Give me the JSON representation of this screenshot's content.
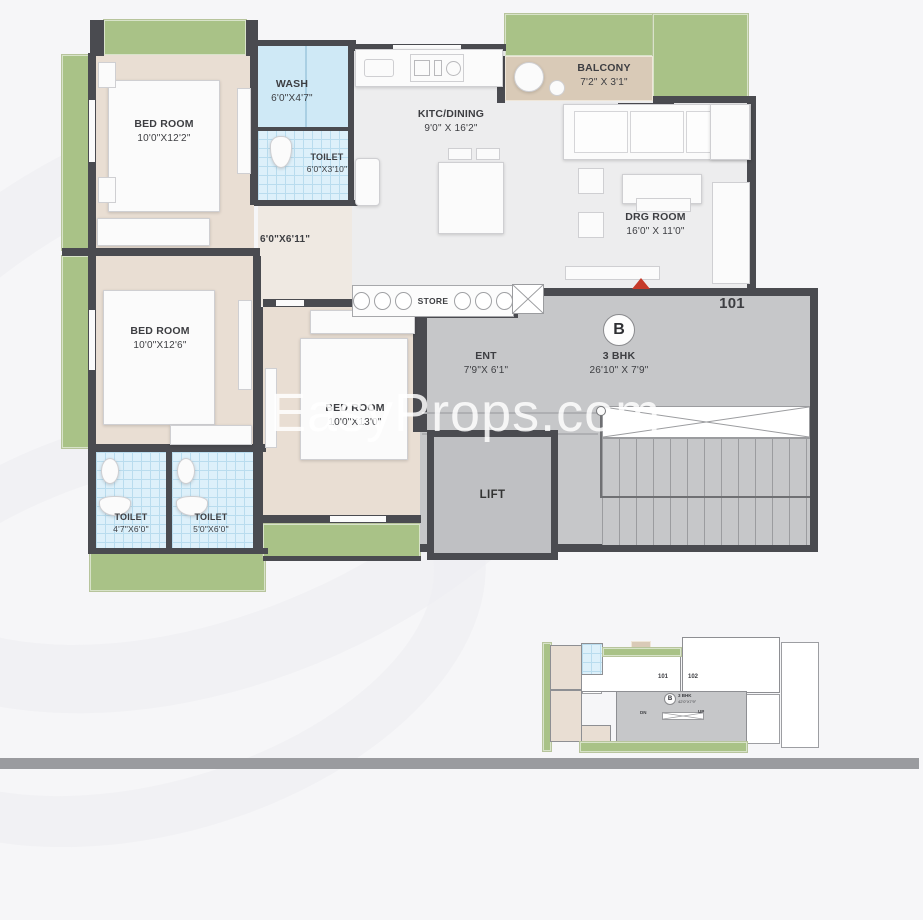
{
  "watermark": "EasyProps.com",
  "plan": {
    "unit_number": "101",
    "unit_badge": "B",
    "unit_type": "3 BHK",
    "unit_dim": "26'10\" X 7'9\"",
    "rooms": {
      "bedroom1": {
        "name": "BED ROOM",
        "dim": "10'0\"X12'2\""
      },
      "wash": {
        "name": "WASH",
        "dim": "6'0\"X4'7\""
      },
      "toilet_top": {
        "name": "TOILET",
        "dim": "6'0\"X3'10\""
      },
      "kitchen": {
        "name": "KITC/DINING",
        "dim": "9'0\" X 16'2\""
      },
      "balcony": {
        "name": "BALCONY",
        "dim": "7'2\" X 3'1\""
      },
      "drawing_room": {
        "name": "DRG ROOM",
        "dim": "16'0\" X 11'0\""
      },
      "passage": {
        "dim": "6'0\"X6'11\""
      },
      "bedroom2": {
        "name": "BED ROOM",
        "dim": "10'0\"X12'6\""
      },
      "store": {
        "name": "STORE"
      },
      "entrance": {
        "name": "ENT",
        "dim": "7'9\"X 6'1\""
      },
      "bedroom3": {
        "name": "BED ROOM",
        "dim": "10'0\"X13'0\""
      },
      "lift": {
        "name": "LIFT"
      },
      "toilet_a": {
        "name": "TOILET",
        "dim": "4'7\"X6'0\""
      },
      "toilet_b": {
        "name": "TOILET",
        "dim": "5'0\"X6'0\""
      }
    }
  },
  "mini": {
    "unit_101": "101",
    "unit_102": "102",
    "badge": "B",
    "unit_type": "3 BHK",
    "unit_dim": "42'0\"X7'9\"",
    "dn": "DN",
    "up": "UP",
    "lift_left": {
      "name": "LIFT",
      "dim": "7'9\"X6'2\""
    },
    "lift_right": {
      "name": "LIFT",
      "dim": "7'9\"X6'2\""
    }
  },
  "colors": {
    "wall": "#4a4b50",
    "balcony_green": "#a9c287",
    "bedroom_beige": "#e9ded3",
    "tile_blue": "#ddf0fa",
    "common_gray": "#c6c7c9",
    "entry_marker_red": "#c63b2a"
  }
}
